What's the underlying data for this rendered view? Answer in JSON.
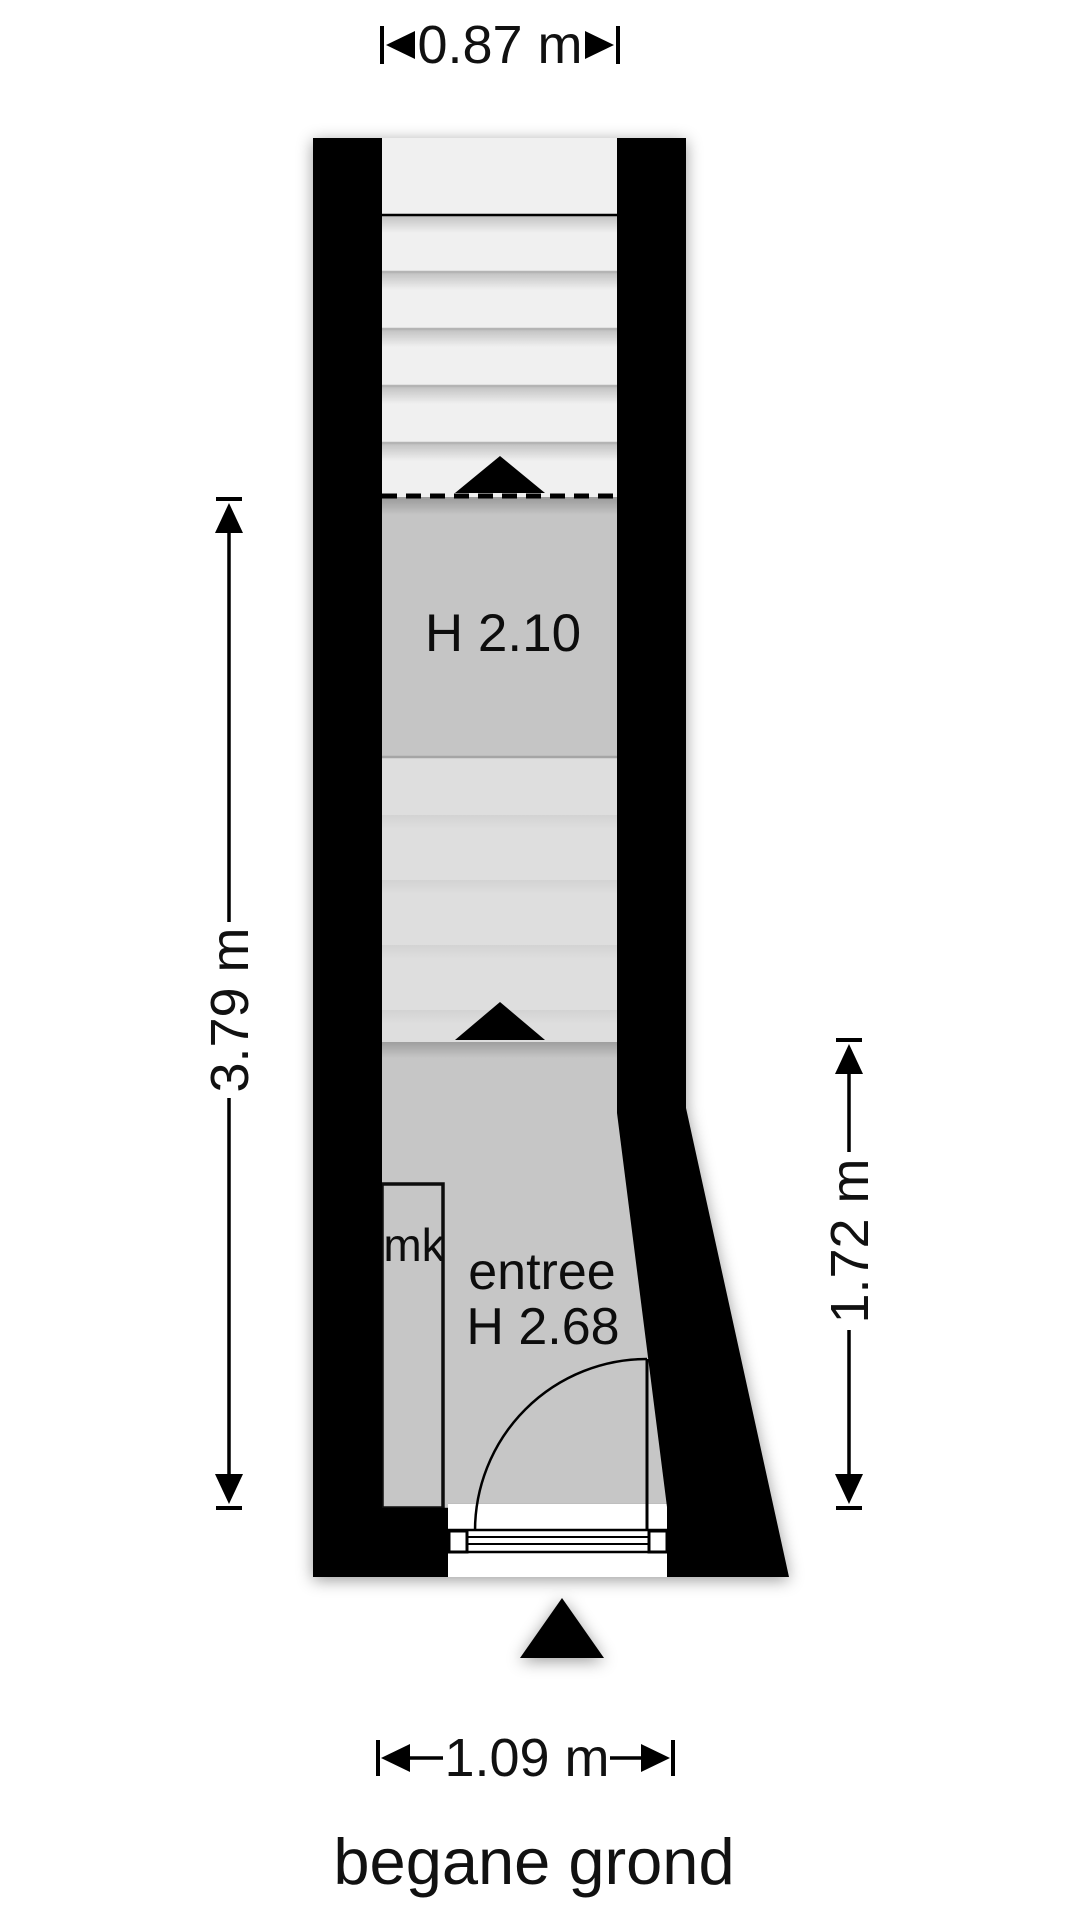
{
  "title": {
    "label": "begane grond"
  },
  "dimensions": {
    "top": {
      "label": "0.87 m"
    },
    "left": {
      "label": "3.79 m"
    },
    "right": {
      "label": "1.72 m"
    },
    "bottom": {
      "label": "1.09 m"
    }
  },
  "rooms": {
    "stair_hall": {
      "height_label": "H 2.10"
    },
    "entree": {
      "name_label": "entree",
      "height_label": "H 2.68"
    },
    "meter_closet": {
      "label": "mk"
    }
  },
  "colors": {
    "wall": "#000000",
    "line": "#000000",
    "stair_white": "#f0f0f0",
    "mid_gray": "#dedede",
    "room_gray": "#c5c5c5",
    "entree_gray": "#c6c6c6",
    "background": "#ffffff"
  }
}
